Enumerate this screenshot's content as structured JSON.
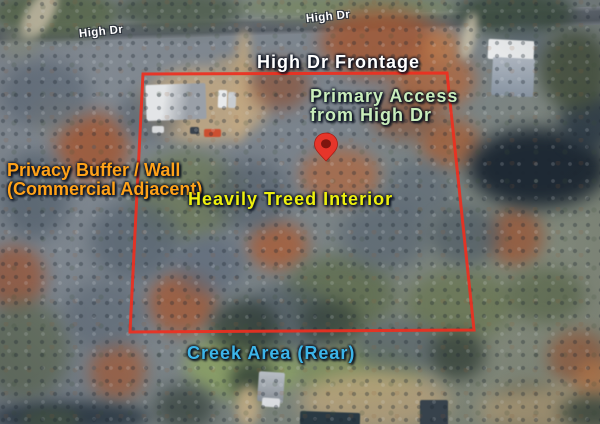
{
  "map": {
    "road_labels": [
      {
        "text": "High Dr"
      },
      {
        "text": "High Dr"
      }
    ],
    "annotations": {
      "frontage": {
        "text": "High Dr Frontage",
        "color": "#ffffff"
      },
      "primary_access": {
        "lines": [
          "Primary Access",
          "from High Dr"
        ],
        "color": "#c9edbb"
      },
      "privacy_buffer": {
        "lines": [
          "Privacy Buffer / Wall",
          "(Commercial Adjacent)"
        ],
        "color": "#ffa219"
      },
      "treed_interior": {
        "text": "Heavily Treed Interior",
        "color": "#eef00e"
      },
      "creek_area": {
        "text": "Creek Area (Rear)",
        "color": "#3cb5e9"
      }
    },
    "boundary": {
      "color": "#ee2f1f"
    },
    "pin": {
      "fill_color": "#e6352a",
      "center_color": "#7e150e"
    }
  }
}
